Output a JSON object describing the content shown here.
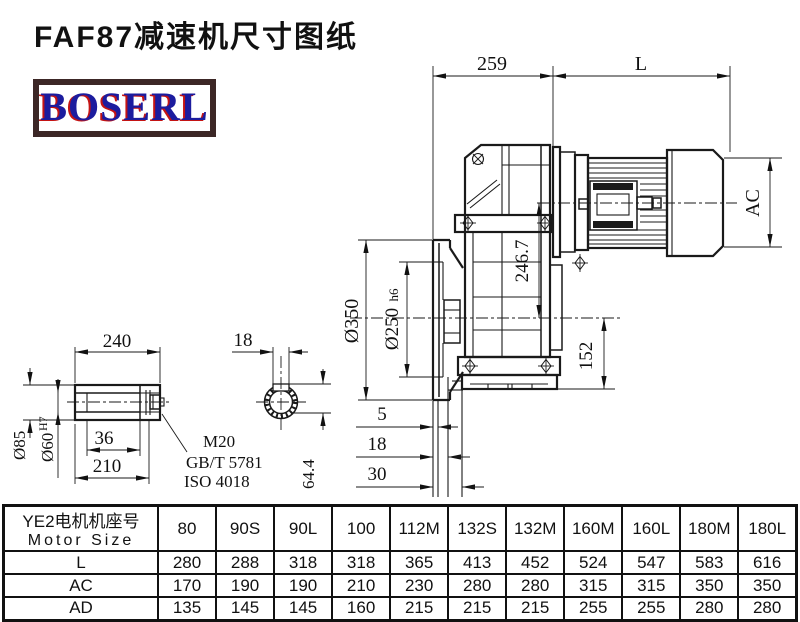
{
  "title": "FAF87减速机尺寸图纸",
  "logo": {
    "text": "BOSERL"
  },
  "colors": {
    "line": "#1a1a1a",
    "logo_blue": "#1c1c9e",
    "logo_red": "#c41414",
    "logo_border": "#3c2726",
    "background": "#ffffff"
  },
  "drawing": {
    "d259": "259",
    "dL": "L",
    "dAC": "AC",
    "d246": "246.7",
    "d152": "152",
    "d350": "Ø350",
    "d250": "Ø250",
    "d250t": "h6",
    "d5": "5",
    "d18s": "18",
    "d30": "30",
    "d240": "240",
    "d85": "Ø85",
    "d60": "Ø60",
    "d60t": "H7",
    "d36": "36",
    "d210": "210",
    "m20": "M20",
    "gbt": "GB/T 5781",
    "iso": "ISO 4018",
    "d18k": "18",
    "d644": "64.4"
  },
  "table": {
    "header_cn": "YE2电机机座号",
    "header_en": "Motor Size",
    "columns": [
      "80",
      "90S",
      "90L",
      "100",
      "112M",
      "132S",
      "132M",
      "160M",
      "160L",
      "180M",
      "180L"
    ],
    "rows": [
      {
        "label": "L",
        "values": [
          "280",
          "288",
          "318",
          "318",
          "365",
          "413",
          "452",
          "524",
          "547",
          "583",
          "616"
        ]
      },
      {
        "label": "AC",
        "values": [
          "170",
          "190",
          "190",
          "210",
          "230",
          "280",
          "280",
          "315",
          "315",
          "350",
          "350"
        ]
      },
      {
        "label": "AD",
        "values": [
          "135",
          "145",
          "145",
          "160",
          "215",
          "215",
          "215",
          "255",
          "255",
          "280",
          "280"
        ]
      }
    ]
  }
}
